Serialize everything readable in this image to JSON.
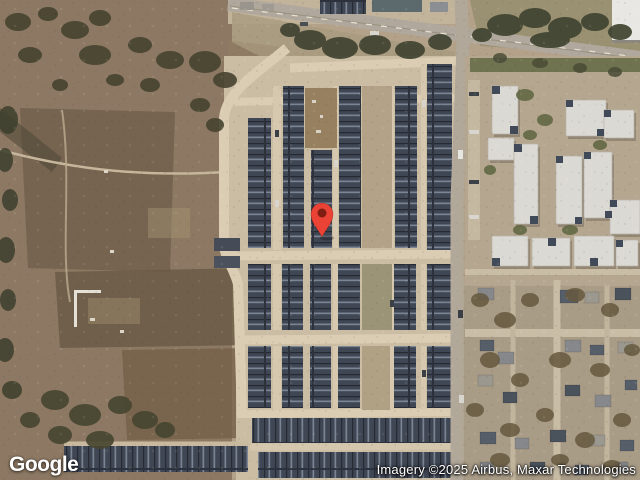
{
  "branding": {
    "logo_text": "Google"
  },
  "attribution": {
    "text": "Imagery ©2025 Airbus, Maxar Technologies"
  },
  "marker": {
    "label": "location-pin",
    "outer_color": "#EA4335",
    "inner_color": "#7E1D12",
    "tip_x": 322,
    "tip_y": 237
  },
  "palette": {
    "terrain_tan": "#b3a289",
    "field_brown": "#8d7963",
    "road_gray": "#b2a899",
    "street_tan": "#dbcdb3",
    "roof_dark": "#3f4654",
    "apartment_light": "#dbd9d3",
    "tree_dark": "#45432f"
  }
}
